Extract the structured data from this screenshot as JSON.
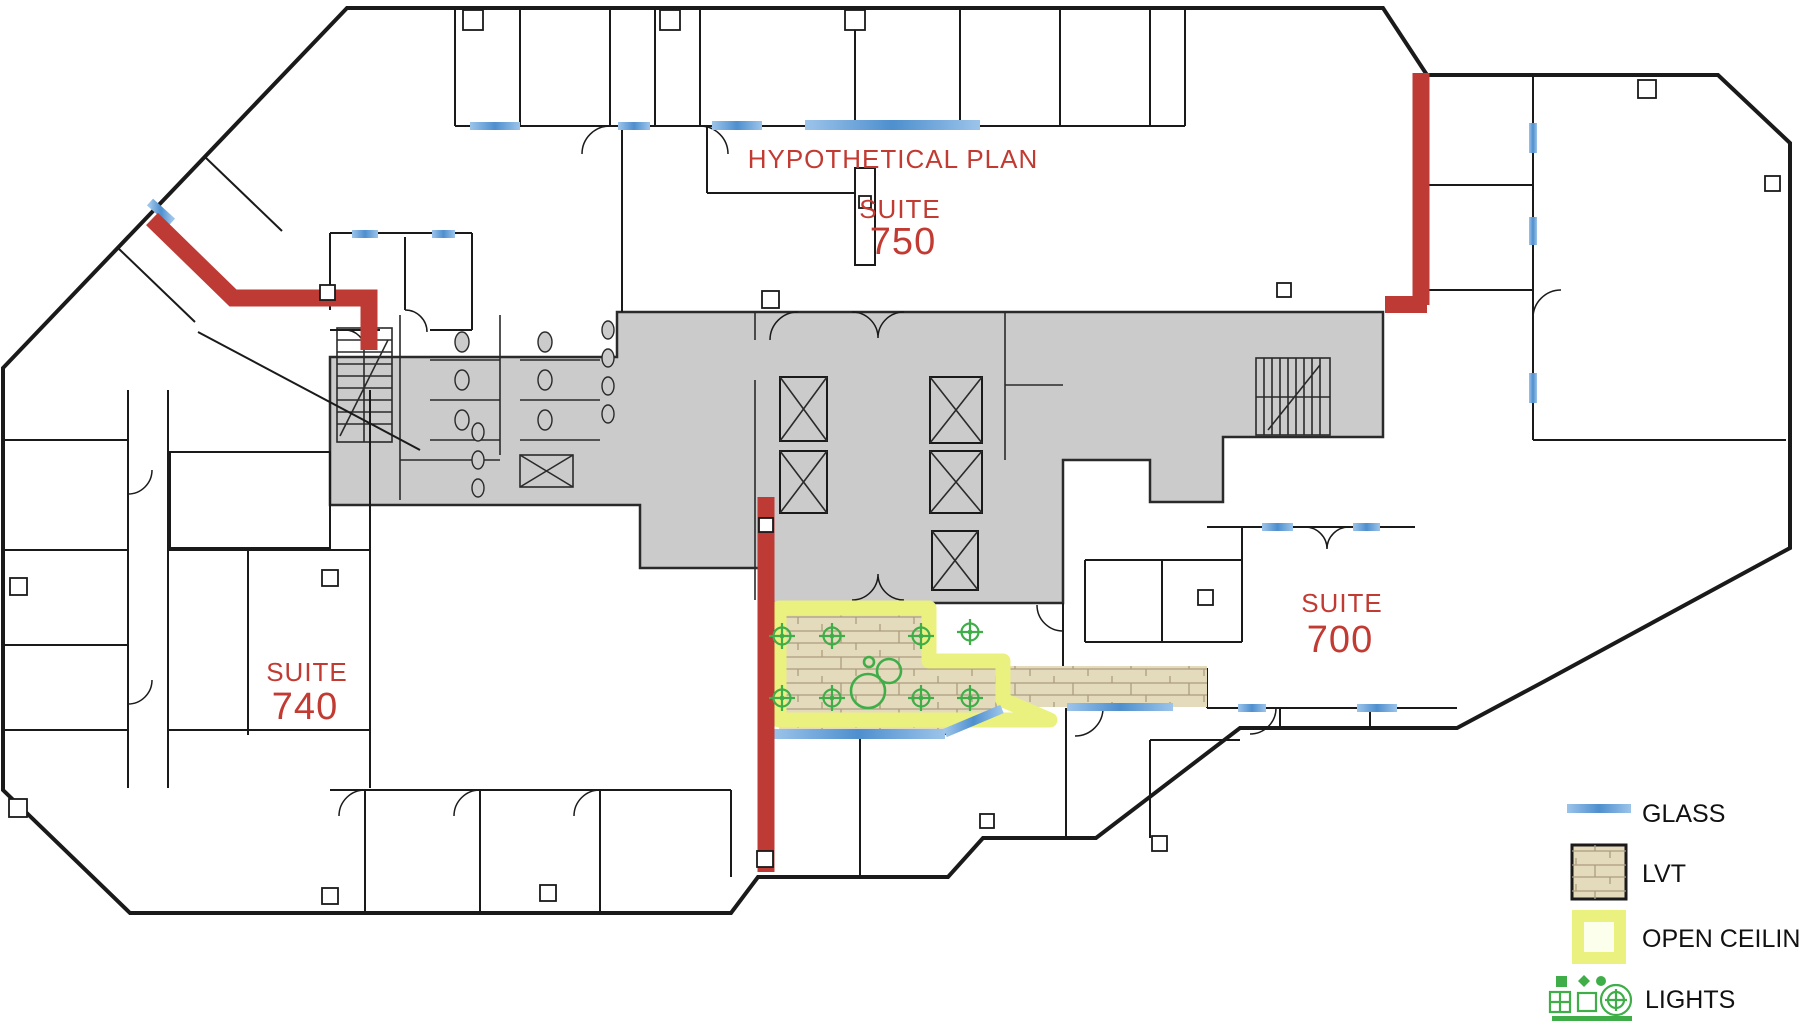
{
  "title": "HYPOTHETICAL PLAN",
  "suites": {
    "s750": {
      "label": "SUITE",
      "number": "750"
    },
    "s740": {
      "label": "SUITE",
      "number": "740"
    },
    "s700": {
      "label": "SUITE",
      "number": "700"
    }
  },
  "legend": {
    "glass": "GLASS",
    "lvt": "LVT",
    "open_ceiling": "OPEN CEILING",
    "lights": "LIGHTS"
  },
  "colors": {
    "demising_red": "#BE3A34",
    "label_red": "#C23B33",
    "core_gray": "#CBCBCB",
    "wall_black": "#1A1A1A",
    "glass_blue": "#5B9BD5",
    "lvt_tan": "#E4DBBD",
    "plank_line": "#AC9D7E",
    "open_ceiling_yellow": "#EBF17E",
    "lights_green": "#3FAE49",
    "legend_text": "#111111"
  }
}
